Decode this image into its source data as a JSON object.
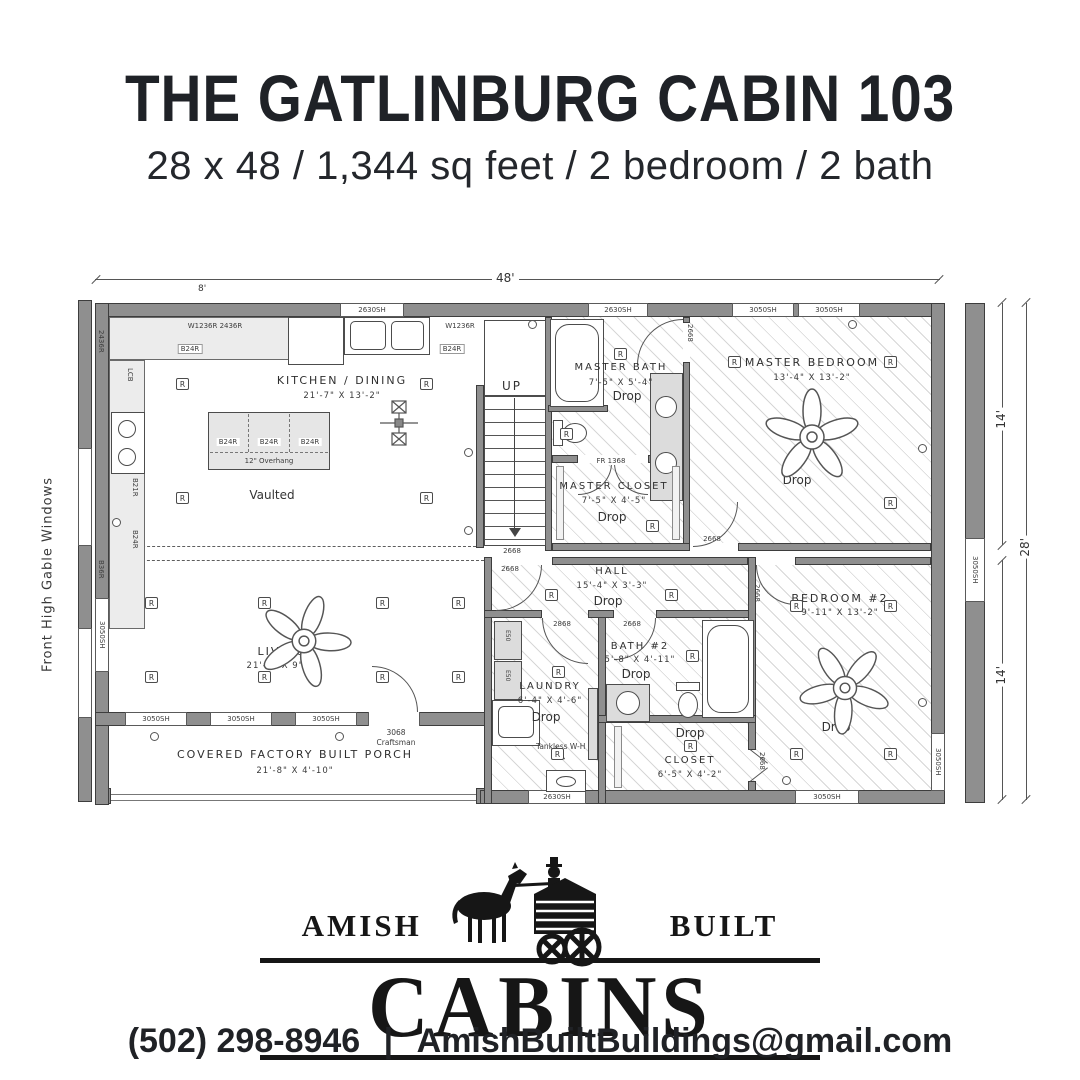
{
  "header": {
    "title": "THE GATLINBURG CABIN 103",
    "subtitle": "28 x 48 / 1,344 sq feet / 2 bedroom / 2 bath"
  },
  "plan": {
    "dimensions": {
      "top": "48'",
      "top_left": "8'",
      "right_upper": "14'",
      "right_lower": "14'",
      "right_total": "28'"
    },
    "side_note": "Front High Gable Windows",
    "symbols": {
      "recessed": "R"
    },
    "rooms": {
      "kitchen": {
        "name": "KITCHEN / DINING",
        "dims": "21'-7\" X 13'-2\"",
        "note": "Vaulted"
      },
      "master_bath": {
        "name": "MASTER BATH",
        "dims": "7'-5\" X 5'-4\"",
        "note": "Drop"
      },
      "master_closet": {
        "name": "MASTER CLOSET",
        "dims": "7'-5\" X 4'-5\"",
        "note": "Drop"
      },
      "master_bedroom": {
        "name": "MASTER BEDROOM",
        "dims": "13'-4\" X 13'-2\"",
        "note": "Drop"
      },
      "hall": {
        "name": "HALL",
        "dims": "15'-4\" X 3'-3\"",
        "note": "Drop"
      },
      "living": {
        "name": "LIVING",
        "dims": "21'-2\" X 9'-4\""
      },
      "laundry": {
        "name": "LAUNDRY",
        "dims": "6'-4\" X 4'-6\"",
        "note": "Drop"
      },
      "bath2": {
        "name": "BATH #2",
        "dims": "5'-8\" X 4'-11\"",
        "note": "Drop"
      },
      "closet2": {
        "name": "CLOSET",
        "dims": "6'-5\" X 4'-2\"",
        "note": "Drop"
      },
      "bedroom2": {
        "name": "BEDROOM #2",
        "dims": "9'-11\" X 13'-2\"",
        "note": "Drop"
      },
      "porch": {
        "name": "COVERED FACTORY BUILT PORCH",
        "dims": "21'-8\" X 4'-10\""
      },
      "stairs": {
        "label": "UP"
      }
    },
    "windows": [
      {
        "label": "2630SH"
      },
      {
        "label": "2630SH"
      },
      {
        "label": "3050SH"
      },
      {
        "label": "3050SH"
      },
      {
        "label": "3050SH"
      },
      {
        "label": "3050SH"
      },
      {
        "label": "3050SH"
      },
      {
        "label": "3050SH"
      },
      {
        "label": "3050SH"
      },
      {
        "label": "2630SH"
      },
      {
        "label": "3050SH"
      },
      {
        "label": "3050SH"
      }
    ],
    "doors": [
      {
        "label": "2668"
      },
      {
        "label": "2668"
      },
      {
        "label": "2668"
      },
      {
        "label": "2668"
      },
      {
        "label": "2868"
      },
      {
        "label": "2668"
      },
      {
        "label": "2668"
      },
      {
        "label": "2668"
      },
      {
        "label": "FR 1368"
      },
      {
        "label": "3068",
        "sub": "Craftsman"
      }
    ],
    "cabinets": {
      "wall_left": "W1236R 2436R",
      "wall_right": "W1236R",
      "base_left": "B24R",
      "base_right": "B24R",
      "corner": "LCB",
      "side1": "2436R",
      "side2": "B21R",
      "side3": "B24R",
      "side4": "B36R",
      "island": [
        "B24R",
        "B24R",
        "B24R"
      ],
      "overhang": "12\" Overhang"
    },
    "appliances": {
      "washer": "E50",
      "dryer": "E50",
      "tankless": "Tankless W-H"
    }
  },
  "logo": {
    "left_word": "AMISH",
    "right_word": "BUILT",
    "main_word": "CABINS"
  },
  "contact": {
    "phone": "(502) 298-8946",
    "separator": "|",
    "email": "AmishBuiltBuildings@gmail.com"
  }
}
